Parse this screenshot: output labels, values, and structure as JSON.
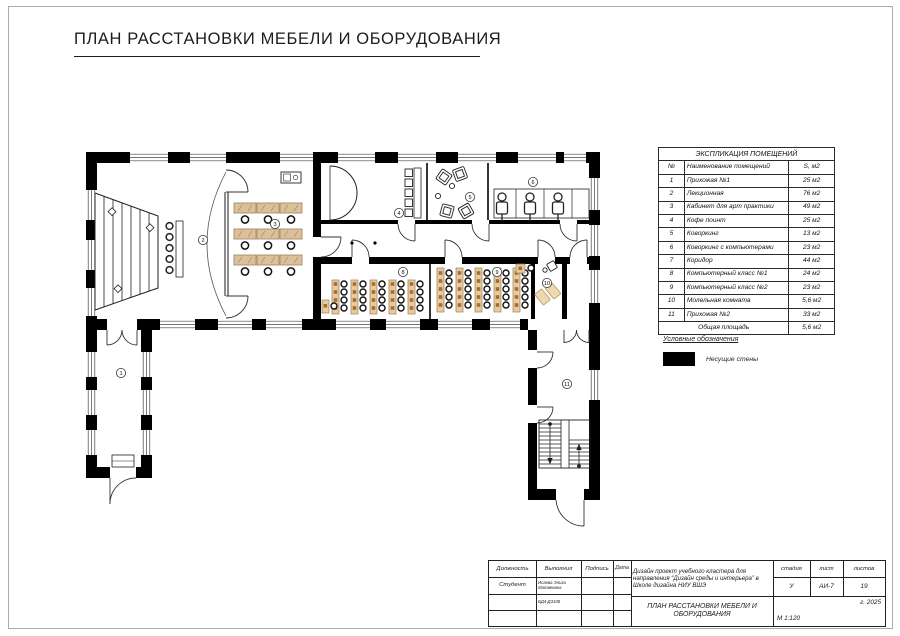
{
  "page": {
    "title": "ПЛАН РАССТАНОВКИ МЕБЕЛИ И ОБОРУДОВАНИЯ"
  },
  "explication": {
    "title": "ЭКСПЛИКАЦИЯ ПОМЕЩЕНИЙ",
    "columns": {
      "num": "№",
      "name": "Наименование помещений",
      "area": "S, м2"
    },
    "rows": [
      {
        "num": "1",
        "name": "Прихожая №1",
        "area": "25 м2"
      },
      {
        "num": "2",
        "name": "Лекционная",
        "area": "76 м2"
      },
      {
        "num": "3",
        "name": "Кабинет для арт практики",
        "area": "49 м2"
      },
      {
        "num": "4",
        "name": "Кофе поинт",
        "area": "25 м2"
      },
      {
        "num": "5",
        "name": "Коворкинг",
        "area": "13 м2"
      },
      {
        "num": "6",
        "name": "Коворкинг с компьютерами",
        "area": "23 м2"
      },
      {
        "num": "7",
        "name": "Коридор",
        "area": "44 м2"
      },
      {
        "num": "8",
        "name": "Компьютерный класс №1",
        "area": "24 м2"
      },
      {
        "num": "9",
        "name": "Компьютерный класс №2",
        "area": "23 м2"
      },
      {
        "num": "10",
        "name": "Молельная комната",
        "area": "5,6 м2"
      },
      {
        "num": "11",
        "name": "Прихожая №2",
        "area": "33 м2"
      }
    ],
    "total": {
      "label": "Общая площадь",
      "area": "5,6 м2"
    }
  },
  "legend": {
    "title": "Условные обозначения",
    "items": [
      {
        "swatch_color": "#000000",
        "label": "Несущие стены"
      }
    ]
  },
  "plan": {
    "markers": [
      "1",
      "2",
      "3",
      "4",
      "5",
      "6",
      "8",
      "9",
      "10",
      "11"
    ],
    "colors": {
      "wall": "#000000",
      "desk_wood": "#dcc09a",
      "monitor": "#b06a28",
      "mat": "#ecd9b0"
    }
  },
  "title_block": {
    "position_header": "Должность",
    "executed_header": "Выполнил",
    "signature_header": "Подпись",
    "date_header": "Дата",
    "position_value": "Студент",
    "executed_value": "Исаева Элиза Матвеевна",
    "group_code": "БД4-Д3108",
    "project_description": "Дизайн проект учебного кластера для направления “Дизайн среды и интерьера” в Школе дизайна НИУ ВШЭ",
    "stage_header": "стадия",
    "sheet_header": "лист",
    "sheets_header": "листов",
    "stage_value": "У",
    "sheet_value": "АИ-7",
    "sheets_value": "19",
    "year": "г. 2025",
    "drawing_title": "ПЛАН РАССТАНОВКИ МЕБЕЛИ И ОБОРУДОВАНИЯ",
    "scale": "М 1:120"
  }
}
